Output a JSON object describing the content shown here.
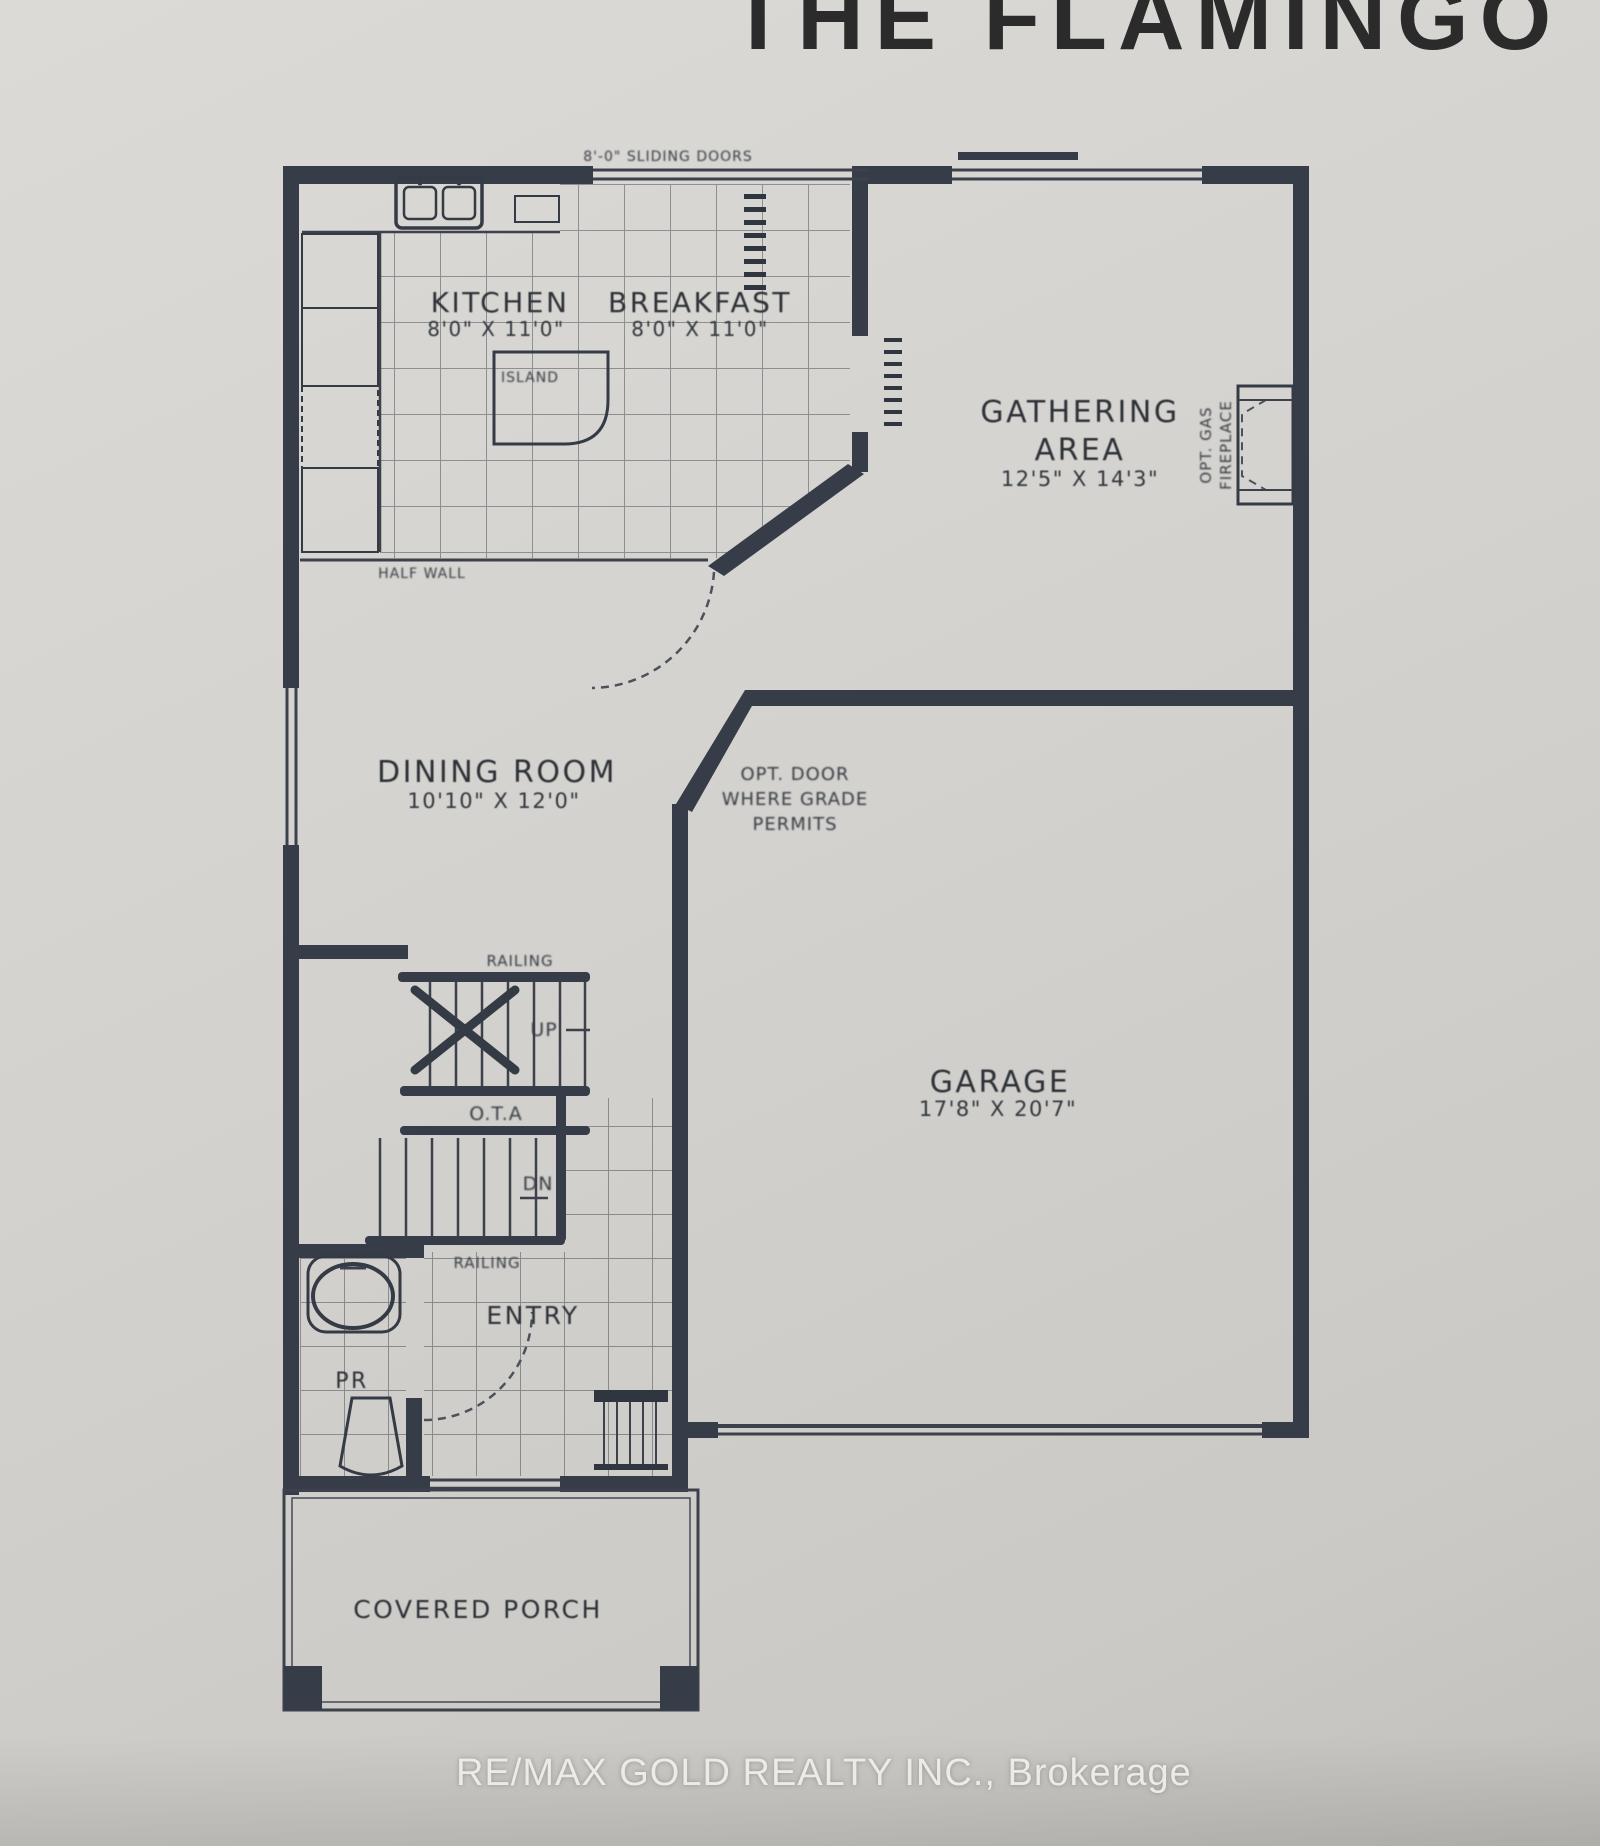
{
  "title": "THE FLAMINGO",
  "watermark": "RE/MAX GOLD REALTY INC., Brokerage",
  "rooms": {
    "kitchen": {
      "name": "KITCHEN",
      "dims": "8'0\" X 11'0\""
    },
    "breakfast": {
      "name": "BREAKFAST",
      "dims": "8'0\" X 11'0\""
    },
    "gathering_area": {
      "name_line1": "GATHERING",
      "name_line2": "AREA",
      "dims": "12'5\" X 14'3\""
    },
    "dining_room": {
      "name": "DINING ROOM",
      "dims": "10'10\" X 12'0\""
    },
    "garage": {
      "name": "GARAGE",
      "dims": "17'8\" X 20'7\""
    },
    "entry": {
      "name": "ENTRY"
    },
    "powder_room": {
      "name": "PR"
    },
    "covered_porch": {
      "name": "COVERED PORCH"
    }
  },
  "annotations": {
    "railing_upper": "RAILING",
    "railing_lower": "RAILING",
    "stairs_up": "UP",
    "stairs_down": "DN",
    "open_to_above": "O.T.A",
    "island": "ISLAND",
    "half_wall": "HALF WALL",
    "sliding_doors": "8'-0\" SLIDING DOORS",
    "opt_door_line1": "OPT. DOOR",
    "opt_door_line2": "WHERE GRADE",
    "opt_door_line3": "PERMITS",
    "opt_fireplace_line1": "OPT. GAS",
    "opt_fireplace_line2": "FIREPLACE"
  },
  "colors": {
    "paper": "#d4d2ce",
    "wall": "#363d49",
    "title_text": "#2b2b2b",
    "watermark_text": "#edebe7"
  }
}
